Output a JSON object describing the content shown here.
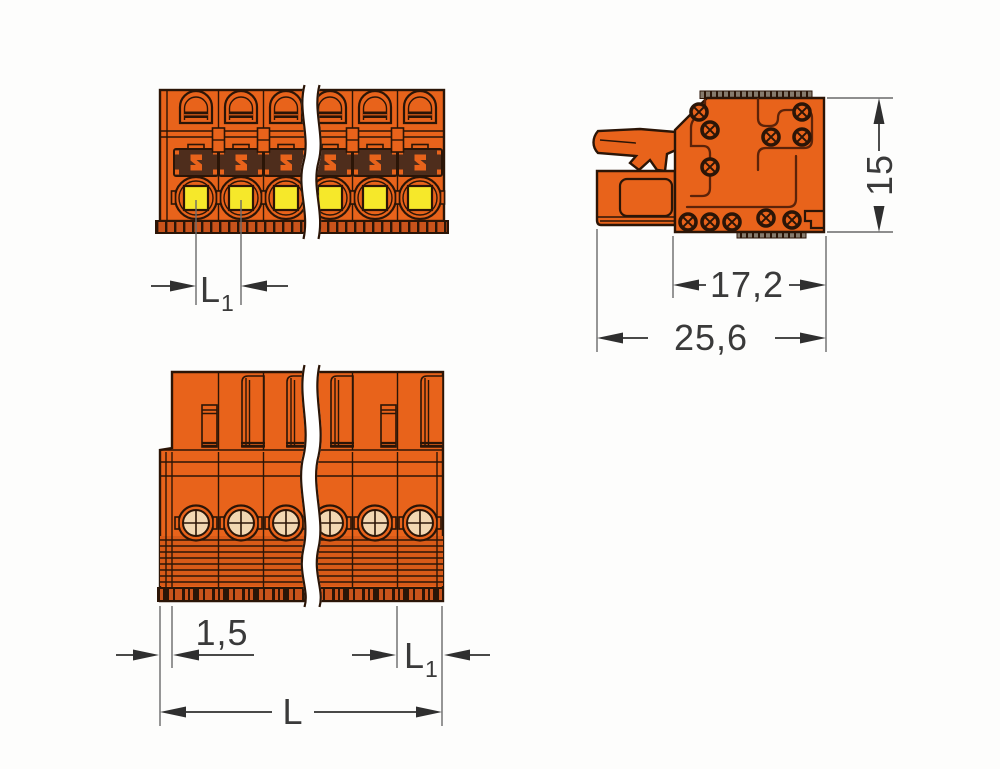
{
  "colors": {
    "background": "#fdfdfc",
    "orange": "#e8631b",
    "orange_deep": "#c9531b",
    "orange_hatch": "#d85a18",
    "outline": "#2b1507",
    "inner_line": "#5c2309",
    "brown": "#4e2d1c",
    "yellow": "#f6e82a",
    "peach": "#f2d7b2",
    "serration": "#857a6c",
    "dim_line": "#2f2f2f",
    "ext_line": "#6a6a6a",
    "dim_text": "#3a3a3a"
  },
  "dimensions": {
    "pitch_top": {
      "base": "L",
      "sub": "1"
    },
    "height_side": {
      "label": "15"
    },
    "depth_body": {
      "label": "17,2"
    },
    "depth_total": {
      "label": "25,6"
    },
    "edge_offset": {
      "label": "1,5"
    },
    "pitch_bottom": {
      "base": "L",
      "sub": "1"
    },
    "total_length": {
      "label": "L"
    }
  },
  "views": {
    "front": {
      "positions_visible": 6
    },
    "bottom": {
      "positions_visible": 6
    }
  }
}
